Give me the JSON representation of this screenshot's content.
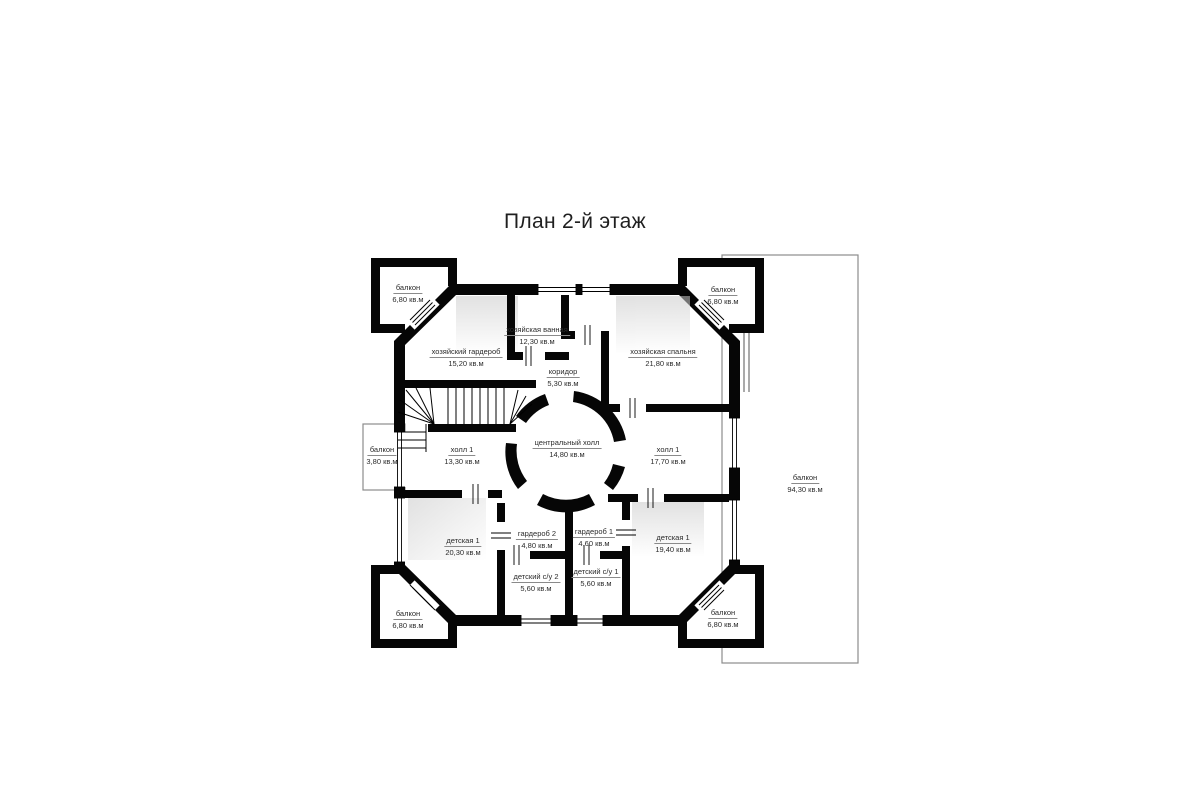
{
  "page": {
    "title": "План 2-й этаж",
    "background": "#ffffff"
  },
  "floor_plan": {
    "wall_color": "#000000",
    "balcony_outline_color": "#8c8c8c",
    "label_color": "#2b2b2b",
    "rooms": [
      {
        "id": "balcony-top-left",
        "name": "балкон",
        "area": "6,80 кв.м"
      },
      {
        "id": "master-wardrobe",
        "name": "хозяйский гардероб",
        "area": "15,20 кв.м"
      },
      {
        "id": "master-bathroom",
        "name": "хозяйская ванная",
        "area": "12,30 кв.м"
      },
      {
        "id": "corridor",
        "name": "коридор",
        "area": "5,30 кв.м"
      },
      {
        "id": "master-bedroom",
        "name": "хозяйская спальня",
        "area": "21,80 кв.м"
      },
      {
        "id": "balcony-top-right",
        "name": "балкон",
        "area": "6,80 кв.м"
      },
      {
        "id": "balcony-left",
        "name": "балкон",
        "area": "3,80 кв.м"
      },
      {
        "id": "hall-left",
        "name": "холл 1",
        "area": "13,30 кв.м"
      },
      {
        "id": "central-hall",
        "name": "центральный холл",
        "area": "14,80 кв.м"
      },
      {
        "id": "hall-right",
        "name": "холл 1",
        "area": "17,70 кв.м"
      },
      {
        "id": "nursery-left",
        "name": "детская 1",
        "area": "20,30 кв.м"
      },
      {
        "id": "wardrobe-2",
        "name": "гардероб 2",
        "area": "4,80 кв.м"
      },
      {
        "id": "wardrobe-1",
        "name": "гардероб 1",
        "area": "4,60 кв.м"
      },
      {
        "id": "kids-bathroom-2",
        "name": "детский с/у 2",
        "area": "5,60 кв.м"
      },
      {
        "id": "kids-bathroom-1",
        "name": "детский с/у 1",
        "area": "5,60 кв.м"
      },
      {
        "id": "nursery-right",
        "name": "детская 1",
        "area": "19,40 кв.м"
      },
      {
        "id": "balcony-bottom-left",
        "name": "балкон",
        "area": "6,80 кв.м"
      },
      {
        "id": "balcony-bottom-right",
        "name": "балкон",
        "area": "6,80 кв.м"
      },
      {
        "id": "balcony-big-right",
        "name": "балкон",
        "area": "94,30 кв.м"
      }
    ]
  }
}
